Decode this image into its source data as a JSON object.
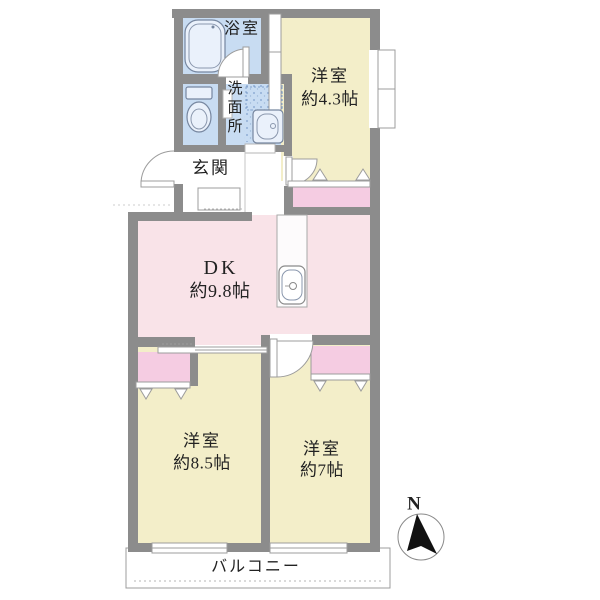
{
  "colors": {
    "wall": "#8c8c8c",
    "room_yellow": "#f3eec9",
    "dk_pink": "#f9e3e8",
    "closet_pink": "#f5cce2",
    "wet_blue": "#c8dcf2",
    "text": "#222222"
  },
  "rooms": {
    "bath": {
      "label": "浴室"
    },
    "washroom": {
      "label": "洗面所",
      "chars": [
        "洗",
        "面",
        "所"
      ]
    },
    "entrance": {
      "label": "玄関"
    },
    "western_room_small": {
      "label": "洋室",
      "size": "約4.3帖"
    },
    "dining_kitchen": {
      "label": "DK",
      "size": "約9.8帖"
    },
    "western_room_large": {
      "label": "洋室",
      "size": "約8.5帖"
    },
    "western_room_mid": {
      "label": "洋室",
      "size": "約7帖"
    },
    "balcony": {
      "label": "バルコニー"
    }
  },
  "compass": {
    "north_label": "N"
  }
}
